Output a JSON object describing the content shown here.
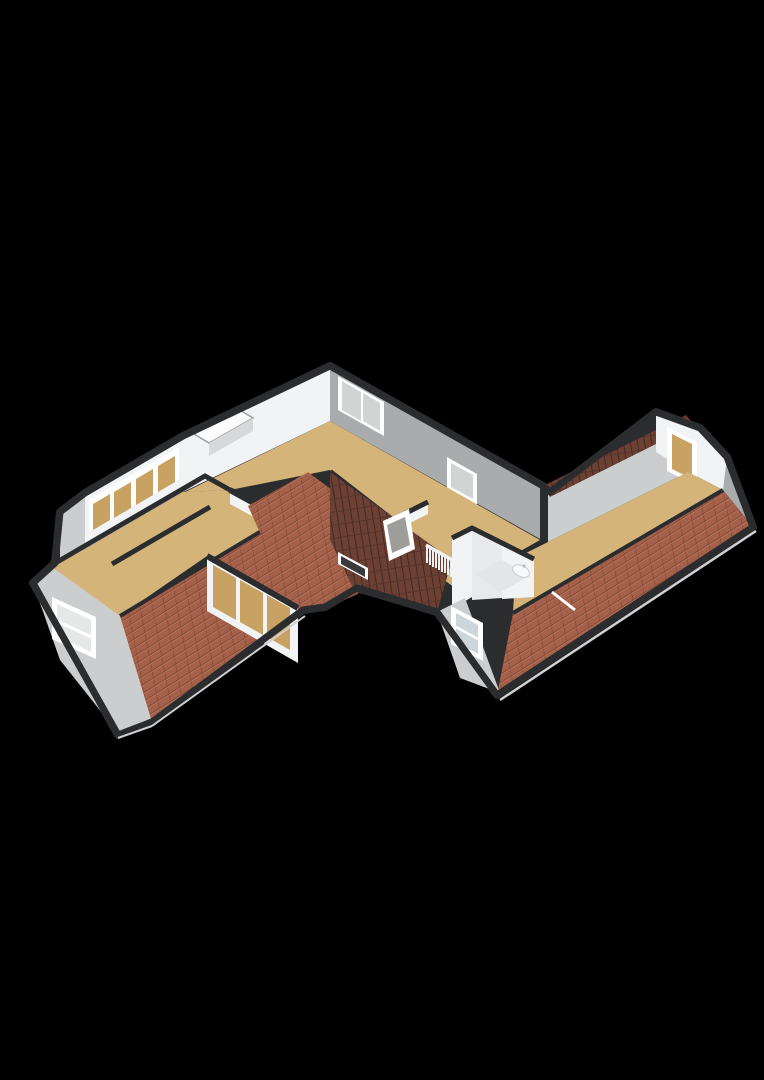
{
  "scene": {
    "type": "isometric-3d-floor-plan",
    "view": "axonometric bird's-eye",
    "background_color": "#000000",
    "storey": "attic floor with sloped tiled roofs",
    "building_shape": "elongated dwelling with offset left and right wings forming a staggered diagonal plan"
  },
  "palette": {
    "background": "#000000",
    "floor_wood": "#d4b479",
    "floor_bathroom": "#e3e6e8",
    "wall_white": "#f2f3f4",
    "wall_bright": "#fbfbfb",
    "wall_gray": "#a9abad",
    "wall_gray_light": "#cbcdce",
    "wall_cap_dark": "#2b2c2e",
    "roof_tile": "#a5604a",
    "roof_tile_line": "#7c4335",
    "roof_tile_dark": "#6d4034",
    "roof_tile_dark_line": "#35241e",
    "window_frame": "#ffffff",
    "glass_tan": "#c8a263",
    "glass_gray": "#9d9d9a",
    "glass_pale": "#e6e7e7",
    "glass_blue": "#ccd5da",
    "railing_white": "#eef0f1",
    "fixture_white": "#f7f9fa",
    "gutter_edge": "#cfd1d2",
    "door_panel": "#3a3a3c"
  },
  "rooms": [
    {
      "id": "left-wing-room",
      "floor": "wood",
      "features": [
        "gable dormer window",
        "tiled roof slope"
      ]
    },
    {
      "id": "window-gallery",
      "floor": "wood",
      "features": [
        "band of four shuttered windows on north wall"
      ]
    },
    {
      "id": "center-left-room",
      "floor": "wood",
      "features": [
        "three-pane window wall facing garden"
      ]
    },
    {
      "id": "front-room",
      "floor": "wood",
      "features": [
        "double casement window",
        "single window"
      ]
    },
    {
      "id": "landing",
      "floor": "wood",
      "features": [
        "stair opening with white railing",
        "roof window on valley slope",
        "interior door"
      ]
    },
    {
      "id": "bathroom",
      "floor": "light",
      "features": [
        "wall-hung wash basin",
        "dormer window"
      ]
    },
    {
      "id": "right-wing-room",
      "floor": "wood",
      "features": [
        "gable window with shade",
        "long tiled roof slope",
        "rear roof slope"
      ]
    }
  ],
  "roof": {
    "tile_color": "#a5604a",
    "sections": [
      "left-wing south slope",
      "center valley slope (dark)",
      "bathroom dormer",
      "right-wing south slope",
      "right-wing north slope"
    ],
    "skylight_count": 1,
    "chimney_present": true
  },
  "window_counts": {
    "front_wall": 2,
    "gallery_band": 4,
    "garden_wall": 3,
    "gable_windows": 2,
    "dormer_windows": 2,
    "roof_windows": 1
  }
}
